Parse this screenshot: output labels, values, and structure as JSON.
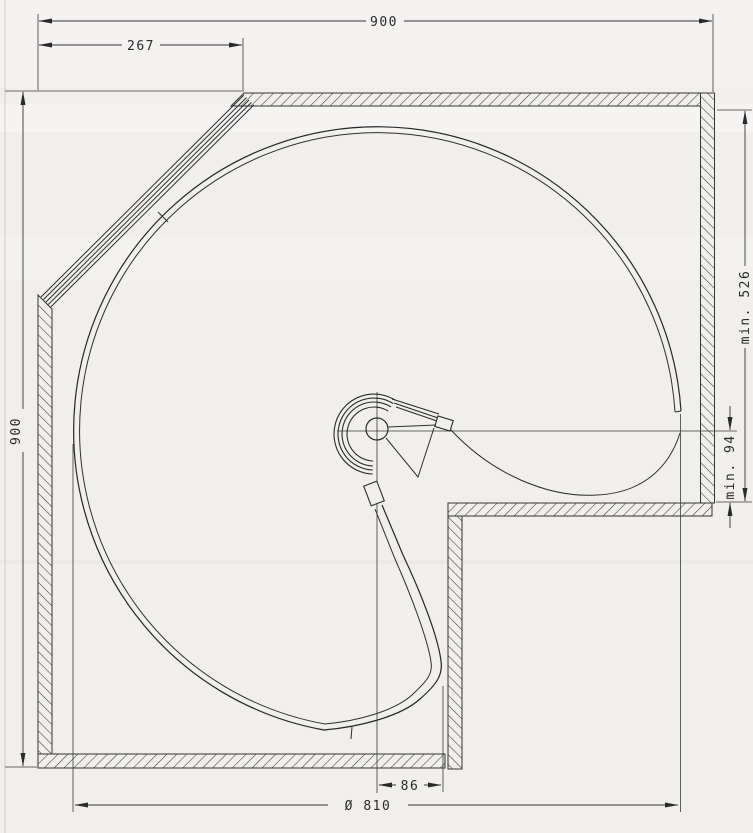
{
  "drawing": {
    "dimensions": {
      "top_width": "900",
      "left_offset": "267",
      "left_height": "900",
      "min_depth_right": "min. 526",
      "min_clearance_right": "min. 94",
      "pivot_to_edge": "86",
      "shelf_diameter": "Ø 810"
    },
    "colors": {
      "paper": "#f1efec",
      "line": "#333333",
      "line_dark": "#222222"
    }
  }
}
